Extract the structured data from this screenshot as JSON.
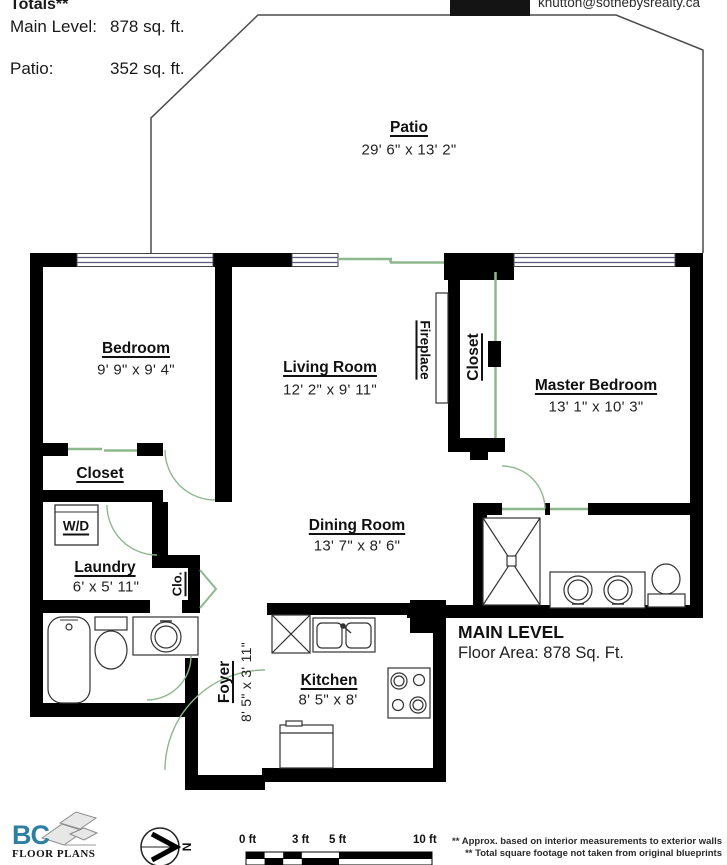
{
  "header": {
    "totals_label": "Totals**",
    "main_level_label": "Main Level:",
    "main_level_value": "878 sq. ft.",
    "patio_label": "Patio:",
    "patio_value": "352 sq. ft.",
    "email": "khutton@sothebysrealty.ca"
  },
  "rooms": {
    "patio": {
      "name": "Patio",
      "dims": "29' 6\" x 13' 2\""
    },
    "bedroom": {
      "name": "Bedroom",
      "dims": "9' 9\" x 9' 4\""
    },
    "living": {
      "name": "Living Room",
      "dims": "12' 2\" x 9' 11\""
    },
    "master": {
      "name": "Master Bedroom",
      "dims": "13' 1\" x 10' 3\""
    },
    "dining": {
      "name": "Dining Room",
      "dims": "13' 7\" x 8' 6\""
    },
    "kitchen": {
      "name": "Kitchen",
      "dims": "8' 5\" x 8'"
    },
    "laundry": {
      "name": "Laundry",
      "dims": "6' x 5' 11\""
    },
    "foyer": {
      "name": "Foyer",
      "dims": "8' 5\" x 3' 11\""
    },
    "closet_bedroom": "Closet",
    "closet_master": "Closet",
    "clo": "Clo.",
    "wd": "W/D",
    "fireplace": "Fireplace"
  },
  "level_summary": {
    "title": "MAIN LEVEL",
    "area": "Floor Area: 878 Sq. Ft."
  },
  "footer": {
    "logo_main": "BC",
    "logo_sub": "FLOOR PLANS",
    "compass_label": "N",
    "scale_ticks": [
      "0 ft",
      "3 ft",
      "5 ft",
      "10 ft"
    ],
    "note1": "** Approx. based on interior measurements to exterior walls",
    "note2": "** Total square footage not taken from original blueprints"
  },
  "colors": {
    "wall": "#000000",
    "door_green": "#8db88d",
    "window_line": "#5b5b7e",
    "logo_blue": "#2e7fa3"
  }
}
